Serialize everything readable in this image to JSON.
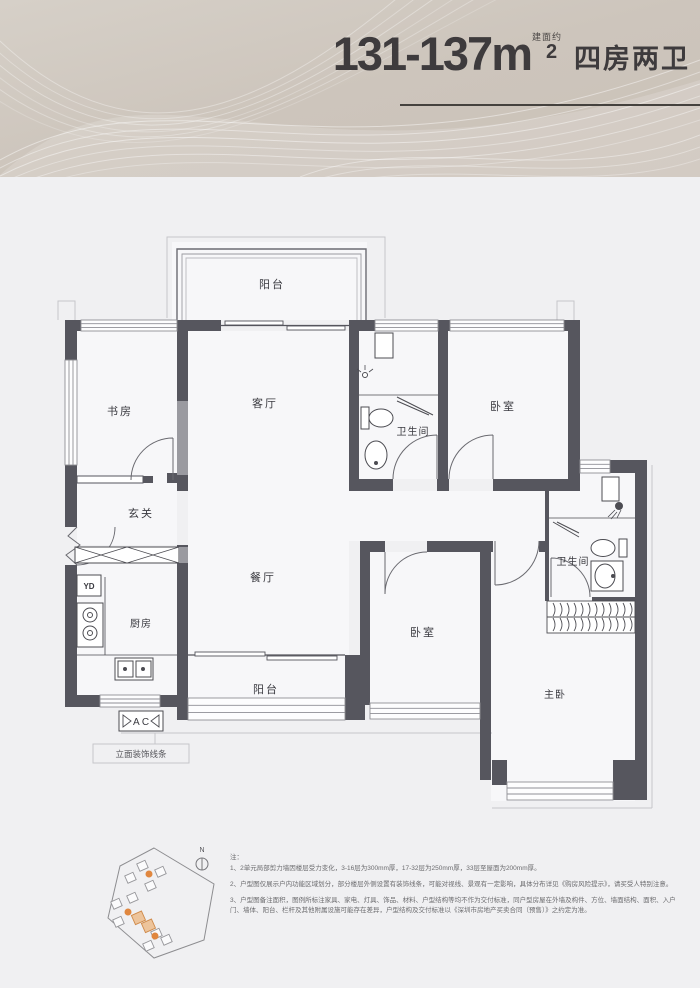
{
  "header": {
    "area_range": "131-137m",
    "area_note": "建面约",
    "area_sup": "2",
    "layout_type": "四房两卫"
  },
  "floorplan": {
    "rooms": {
      "balcony_top": "阳台",
      "study": "书房",
      "living": "客厅",
      "bath1": "卫生间",
      "bedroom1": "卧室",
      "foyer": "玄关",
      "dining": "餐厅",
      "kitchen": "厨房",
      "balcony_bottom": "阳台",
      "bedroom2": "卧室",
      "bath2": "卫生间",
      "master": "主卧"
    },
    "tags": {
      "yd": "YD",
      "ac": "A C",
      "facade_note": "立面装饰线条"
    },
    "colors": {
      "wall": "#56565e",
      "accent_orange": "#e0873f",
      "header_beige": "#cfc7be"
    }
  },
  "sitemap": {
    "compass": "N"
  },
  "notes": {
    "title": "注：",
    "items": [
      "1、2单元局部剪力墙因楼层受力变化，3-16层为300mm厚，17-32层为250mm厚，33层至屋面为200mm厚。",
      "2、户型图仅展示户内功能区域划分，部分楼层外侧设置有装饰线条，可能对视线、景观有一定影响，具体分布详见《购房风险提示》，请买受人特别注意。",
      "3、户型图备注面积，图例所标注家具、家电、灯具、饰品、材料、户型结构等均不作为交付标准，同户型房屋在外墙及构件、方位、墙面结构、面积、入户门、墙体、阳台、栏杆及其他附属设施可能存在差异，户型结构及交付标准以《深圳市房地产买卖合同（预售）》之约定为准。"
    ]
  }
}
